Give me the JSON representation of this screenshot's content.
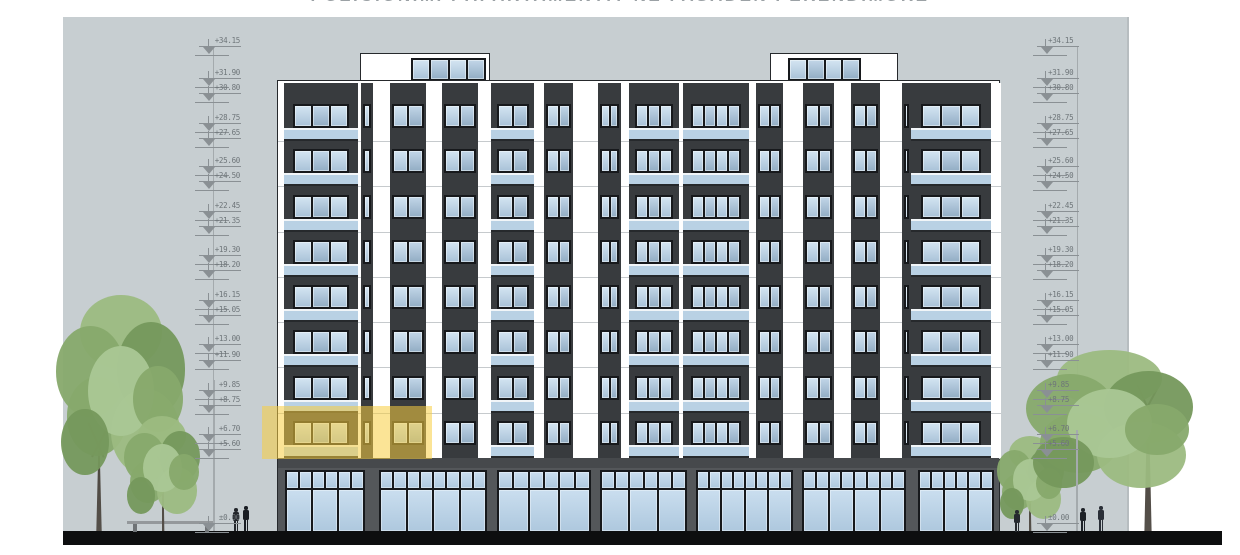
{
  "title": {
    "text": "POZICIONIMI I APARTAMENTIT NE FASADEN PERENDIMORE"
  },
  "colors": {
    "sky": "#c7ced1",
    "sky_edge": "#b7bdc0",
    "wall_dark": "#383b3e",
    "wall_white": "#ffffff",
    "frame": "#17191c",
    "glass_a": [
      "#d4e5f2",
      "#a9c2d8"
    ],
    "glass_b": [
      "#c2d6e8",
      "#92adc4"
    ],
    "glass_store": [
      "#cadeef",
      "#aec8de"
    ],
    "rail": "#b9d1e4",
    "rail_top": "#f1f5f8",
    "fascia": "#46494c",
    "store_bg": "#54575a",
    "base_black": "#0d0e0f",
    "slab_line": "#c6cacd",
    "marker": "#8a9094",
    "marker_text": "#6e7579",
    "leader": "#a4aaad",
    "outline": "#26292c",
    "trunk": "#55504a",
    "branch": "#4c463f",
    "canopy": [
      "#87a96c",
      "#9cbb81",
      "#75985c",
      "#aac795"
    ],
    "bench": "#94989b",
    "bench_leg": "#6f7376",
    "highlight": "rgba(247,205,64,0.55)"
  },
  "drawing": {
    "type": "architectural-elevation",
    "columns": {
      "left_x": 195,
      "right_x": 1033
    },
    "markers": [
      {
        "label": "+34.15",
        "y": 46
      },
      {
        "label": "+31.90",
        "y": 78
      },
      {
        "label": "+30.80",
        "y": 93
      },
      {
        "label": "+28.75",
        "y": 123
      },
      {
        "label": "+27.65",
        "y": 138
      },
      {
        "label": "+25.60",
        "y": 166
      },
      {
        "label": "+24.50",
        "y": 181
      },
      {
        "label": "+22.45",
        "y": 211
      },
      {
        "label": "+21.35",
        "y": 226
      },
      {
        "label": "+19.30",
        "y": 255
      },
      {
        "label": "+18.20",
        "y": 270
      },
      {
        "label": "+16.15",
        "y": 300
      },
      {
        "label": "+15.05",
        "y": 315
      },
      {
        "label": "+13.00",
        "y": 344
      },
      {
        "label": "+11.90",
        "y": 360
      },
      {
        "label": "+9.85",
        "y": 390
      },
      {
        "label": "+8.75",
        "y": 405
      },
      {
        "label": "+6.70",
        "y": 434
      },
      {
        "label": "+5.60",
        "y": 449
      },
      {
        "label": "±0.00",
        "y": 523
      }
    ]
  },
  "building": {
    "x": 277,
    "w": 723,
    "top": 80,
    "h": 452,
    "floors_offset": 2,
    "floors_h": 375,
    "rows": 8,
    "row_pad": 13,
    "row_h": 45.25,
    "bays": [
      {
        "type": "white",
        "x": 0,
        "w": 6,
        "strips": []
      },
      {
        "type": "balcony",
        "x": 6,
        "w": 74,
        "panes": 3
      },
      {
        "type": "white",
        "x": 80,
        "w": 133,
        "strips": [
          {
            "x": 3,
            "w": 12,
            "panes": 1
          },
          {
            "x": 32,
            "w": 36,
            "panes": 2
          },
          {
            "x": 84,
            "w": 36,
            "panes": 2
          }
        ]
      },
      {
        "type": "balcony",
        "x": 213,
        "w": 43,
        "panes": 2
      },
      {
        "type": "white",
        "x": 256,
        "w": 95,
        "strips": [
          {
            "x": 10,
            "w": 29,
            "panes": 2
          },
          {
            "x": 64,
            "w": 23,
            "panes": 2
          }
        ]
      },
      {
        "type": "balcony",
        "x": 351,
        "w": 50,
        "panes": 3
      },
      {
        "type": "white",
        "x": 401,
        "w": 4,
        "strips": []
      },
      {
        "type": "balcony",
        "x": 405,
        "w": 66,
        "panes": 4
      },
      {
        "type": "white",
        "x": 471,
        "w": 162,
        "strips": [
          {
            "x": 7,
            "w": 27,
            "panes": 2
          },
          {
            "x": 54,
            "w": 31,
            "panes": 2
          },
          {
            "x": 102,
            "w": 29,
            "panes": 2
          },
          {
            "x": 153,
            "w": 9,
            "panes": 1
          }
        ]
      },
      {
        "type": "balcony",
        "x": 633,
        "w": 80,
        "panes": 3
      },
      {
        "type": "white",
        "x": 713,
        "w": 10,
        "strips": []
      }
    ],
    "penthouses": [
      {
        "x": 83,
        "w": 130,
        "win_x": 50,
        "win_w": 75,
        "panes": 4
      },
      {
        "x": 493,
        "w": 128,
        "win_x": 17,
        "win_w": 73,
        "panes": 4
      }
    ],
    "penthouse_y": 53,
    "penthouse_h": 29,
    "fascia": {
      "y": 377,
      "h": 10
    },
    "storefront": {
      "y": 387,
      "h": 65,
      "sections": [
        {
          "x": 7,
          "w": 80,
          "panes": 3
        },
        {
          "x": 101,
          "w": 108,
          "panes": 4
        },
        {
          "x": 219,
          "w": 94,
          "panes": 3
        },
        {
          "x": 322,
          "w": 87,
          "panes": 3
        },
        {
          "x": 418,
          "w": 97,
          "panes": 4
        },
        {
          "x": 524,
          "w": 104,
          "panes": 4
        },
        {
          "x": 640,
          "w": 76,
          "panes": 3
        }
      ]
    }
  },
  "highlight": {
    "x": 262,
    "y": 406,
    "w": 170,
    "h": 53
  },
  "scene": {
    "sky": {
      "x": 63,
      "y": 17,
      "w": 1064,
      "h": 514
    },
    "ground": {
      "x": 63,
      "y": 531,
      "w": 1159,
      "h": 14
    },
    "leaders": [
      {
        "x": 213,
        "y1": 46,
        "y2": 531
      },
      {
        "x": 1077,
        "y1": 46,
        "y2": 531
      }
    ],
    "poles": [
      {
        "x": 213,
        "y": 380,
        "h": 151
      },
      {
        "x": 1076,
        "y": 430,
        "h": 101
      }
    ],
    "trees": [
      {
        "name": "tree-left-large",
        "canopy": {
          "x": 56,
          "y": 295,
          "w": 132,
          "h": 196
        },
        "trunk": {
          "cx": 99,
          "h": 80,
          "w": 6
        }
      },
      {
        "name": "tree-left-small",
        "canopy": {
          "x": 124,
          "y": 416,
          "w": 78,
          "h": 106
        },
        "trunk": {
          "cx": 163,
          "h": 58,
          "w": 3
        }
      },
      {
        "name": "tree-right-small",
        "canopy": {
          "x": 997,
          "y": 436,
          "w": 68,
          "h": 90
        },
        "trunk": {
          "cx": 1030,
          "h": 48,
          "w": 3
        }
      },
      {
        "name": "tree-right-large",
        "canopy": {
          "x": 1026,
          "y": 350,
          "w": 170,
          "h": 150
        },
        "trunk": {
          "cx": 1148,
          "h": 118,
          "w": 8
        }
      }
    ],
    "people": [
      {
        "x": 232,
        "h": 23,
        "c": "#23262b"
      },
      {
        "x": 242,
        "h": 25,
        "c": "#191d23"
      },
      {
        "x": 1013,
        "h": 21,
        "c": "#262a2f"
      },
      {
        "x": 1079,
        "h": 23,
        "c": "#1e2228"
      },
      {
        "x": 1097,
        "h": 25,
        "c": "#2a2f37"
      }
    ],
    "bench": {
      "x": 127,
      "y": 521,
      "w": 88,
      "h": 11
    }
  }
}
